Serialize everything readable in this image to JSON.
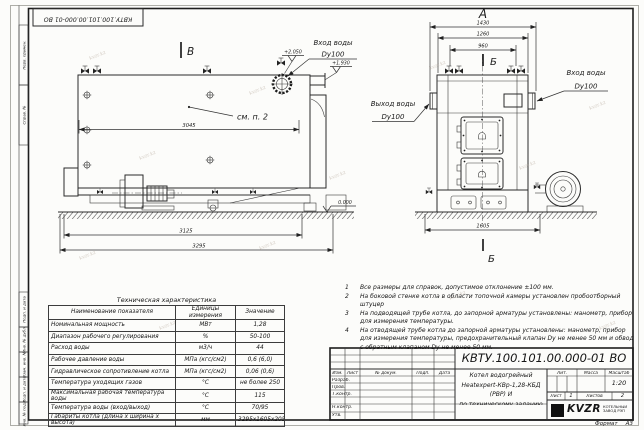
{
  "sheet": {
    "stamp_doc_number": "КВТУ.100.101.00.000-01 ВО",
    "watermark": "kvzr.kz",
    "margin_labels": {
      "perv_primen": "Перв. примен.",
      "sprav_no": "Справ. №",
      "podp_data_1": "Подп. и дата",
      "inv_dubl": "Инв. № дубл.",
      "vzam_inv": "Взам. инв. №",
      "podp_data_2": "Подп. и дата",
      "inv_podl": "Инв. № подл."
    },
    "format_label": "Формат",
    "format_value": "А3"
  },
  "left_view": {
    "section_label": "В",
    "note_ref": "см. п. 2",
    "inlet_line1": "Вход воды",
    "inlet_line2": "Dy100",
    "elev_high": "+2.050",
    "elev_mid": "+1.930",
    "elev_zero": "0.000",
    "dim_inner": "3045",
    "dim_mid": "3125",
    "dim_outer": "3295"
  },
  "right_view": {
    "view_label": "А",
    "section_label_top": "Б",
    "section_label_bottom": "Б",
    "dim_top1": "1430",
    "dim_top2": "1260",
    "dim_top3": "960",
    "dim_bottom": "1605",
    "outlet_line1": "Выход воды",
    "outlet_line2": "Dy100",
    "inlet_line1": "Вход воды",
    "inlet_line2": "Dy100"
  },
  "notes": [
    {
      "n": "1",
      "t": "Все размеры для справок, допустимое отклонение ±100 мм."
    },
    {
      "n": "2",
      "t": "На боковой стенке котла в области топочной камеры установлен пробоотборный штуцер"
    },
    {
      "n": "3",
      "t": "На подводящей трубе котла, до запорной арматуры установлены: манометр, прибор для измерения температуры."
    },
    {
      "n": "4",
      "t": "На отводящей трубе котла до запорной арматуры установлены: манометр, прибор для измерения температуры, предохранительный клапан Dу не менее 50 мм и обвод с обратным клапаном Dу не менее 50 мм."
    }
  ],
  "spec_table": {
    "title": "Техническая характеристика",
    "headers": [
      "Наименование показателя",
      "Единицы измерения",
      "Значение"
    ],
    "rows": [
      [
        "Номинальная мощность",
        "МВт",
        "1,28"
      ],
      [
        "Диапазон рабочего регулирования",
        "%",
        "50-100"
      ],
      [
        "Расход воды",
        "м3/ч",
        "44"
      ],
      [
        "Рабочее давление воды",
        "МПа (кгс/см2)",
        "0,6 (6,0)"
      ],
      [
        "Гидравлическое сопротивление котла",
        "МПа (кгс/см2)",
        "0,06 (0,6)"
      ],
      [
        "Температура уходящих газов",
        "°С",
        "не более 250"
      ],
      [
        "Максимальная рабочая температура воды",
        "°С",
        "115"
      ],
      [
        "Температура воды (вход/выход)",
        "°С",
        "70/95"
      ],
      [
        "Габариты котла (длина х ширина х высота)",
        "мм",
        "3295х1605х2050"
      ]
    ]
  },
  "title_block": {
    "doc_number": "КВТУ.100.101.00.000-01 ВО",
    "description_line1": "Котел водогрейный",
    "description_line2": "Heatexpert-КВр-1,28-КБД (РВР) И",
    "description_line3": "по техническому заданию",
    "cols": {
      "izm": "Изм.",
      "list": "Лист",
      "doc": "№ докум.",
      "podp": "Подп.",
      "data": "Дата"
    },
    "rows": {
      "razrab": "Разраб.",
      "prov": "Пров.",
      "tkontr": "Т.контр.",
      "nkontr": "Н.контр.",
      "utv": "Утв."
    },
    "lit_label": "Лит.",
    "mass_label": "Масса",
    "scale_label": "Масштаб",
    "scale_value": "1:20",
    "sheet_label": "Лист",
    "sheet_value": "1",
    "sheets_label": "Листов",
    "sheets_value": "2",
    "logo_text": "KVZR",
    "company_line1": "КОТЕЛЬНЫЙ",
    "company_line2": "ЗАВОД РЭП"
  }
}
